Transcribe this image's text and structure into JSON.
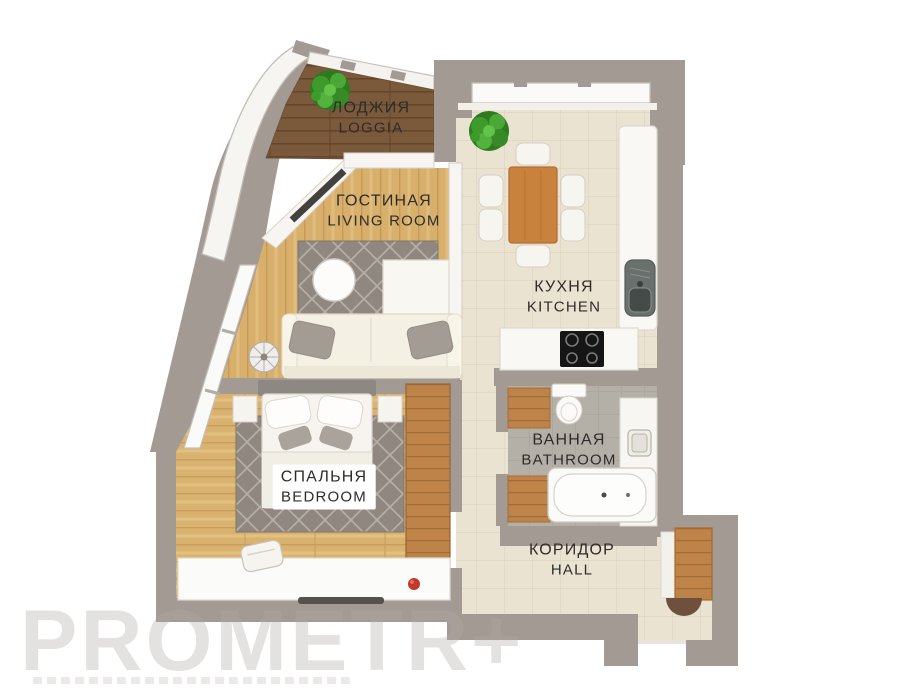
{
  "watermark": {
    "text": "PROMETR+"
  },
  "rooms": {
    "loggia": {
      "label_ru": "ЛОДЖИЯ",
      "label_en": "LOGGIA"
    },
    "living": {
      "label_ru": "ГОСТИНАЯ",
      "label_en": "LIVING ROOM"
    },
    "kitchen": {
      "label_ru": "КУХНЯ",
      "label_en": "KITCHEN"
    },
    "bathroom": {
      "label_ru": "ВАННАЯ",
      "label_en": "BATHROOM"
    },
    "bedroom": {
      "label_ru": "СПАЛЬНЯ",
      "label_en": "BEDROOM"
    },
    "hall": {
      "label_ru": "КОРИДОР",
      "label_en": "HALL"
    }
  },
  "colors": {
    "wall": "#a49a94",
    "wood_light": "#d8b06c",
    "wood_dark": "#7b5a3c",
    "tile_beige": "#ebe3d1",
    "tile_gray": "#b5b0a7",
    "furniture_wood": "#c9823e",
    "rug": "#8f8780",
    "accent_red": "#c2382c",
    "plant_green": "#3f9a2c",
    "label_text": "#2e2c2a"
  }
}
